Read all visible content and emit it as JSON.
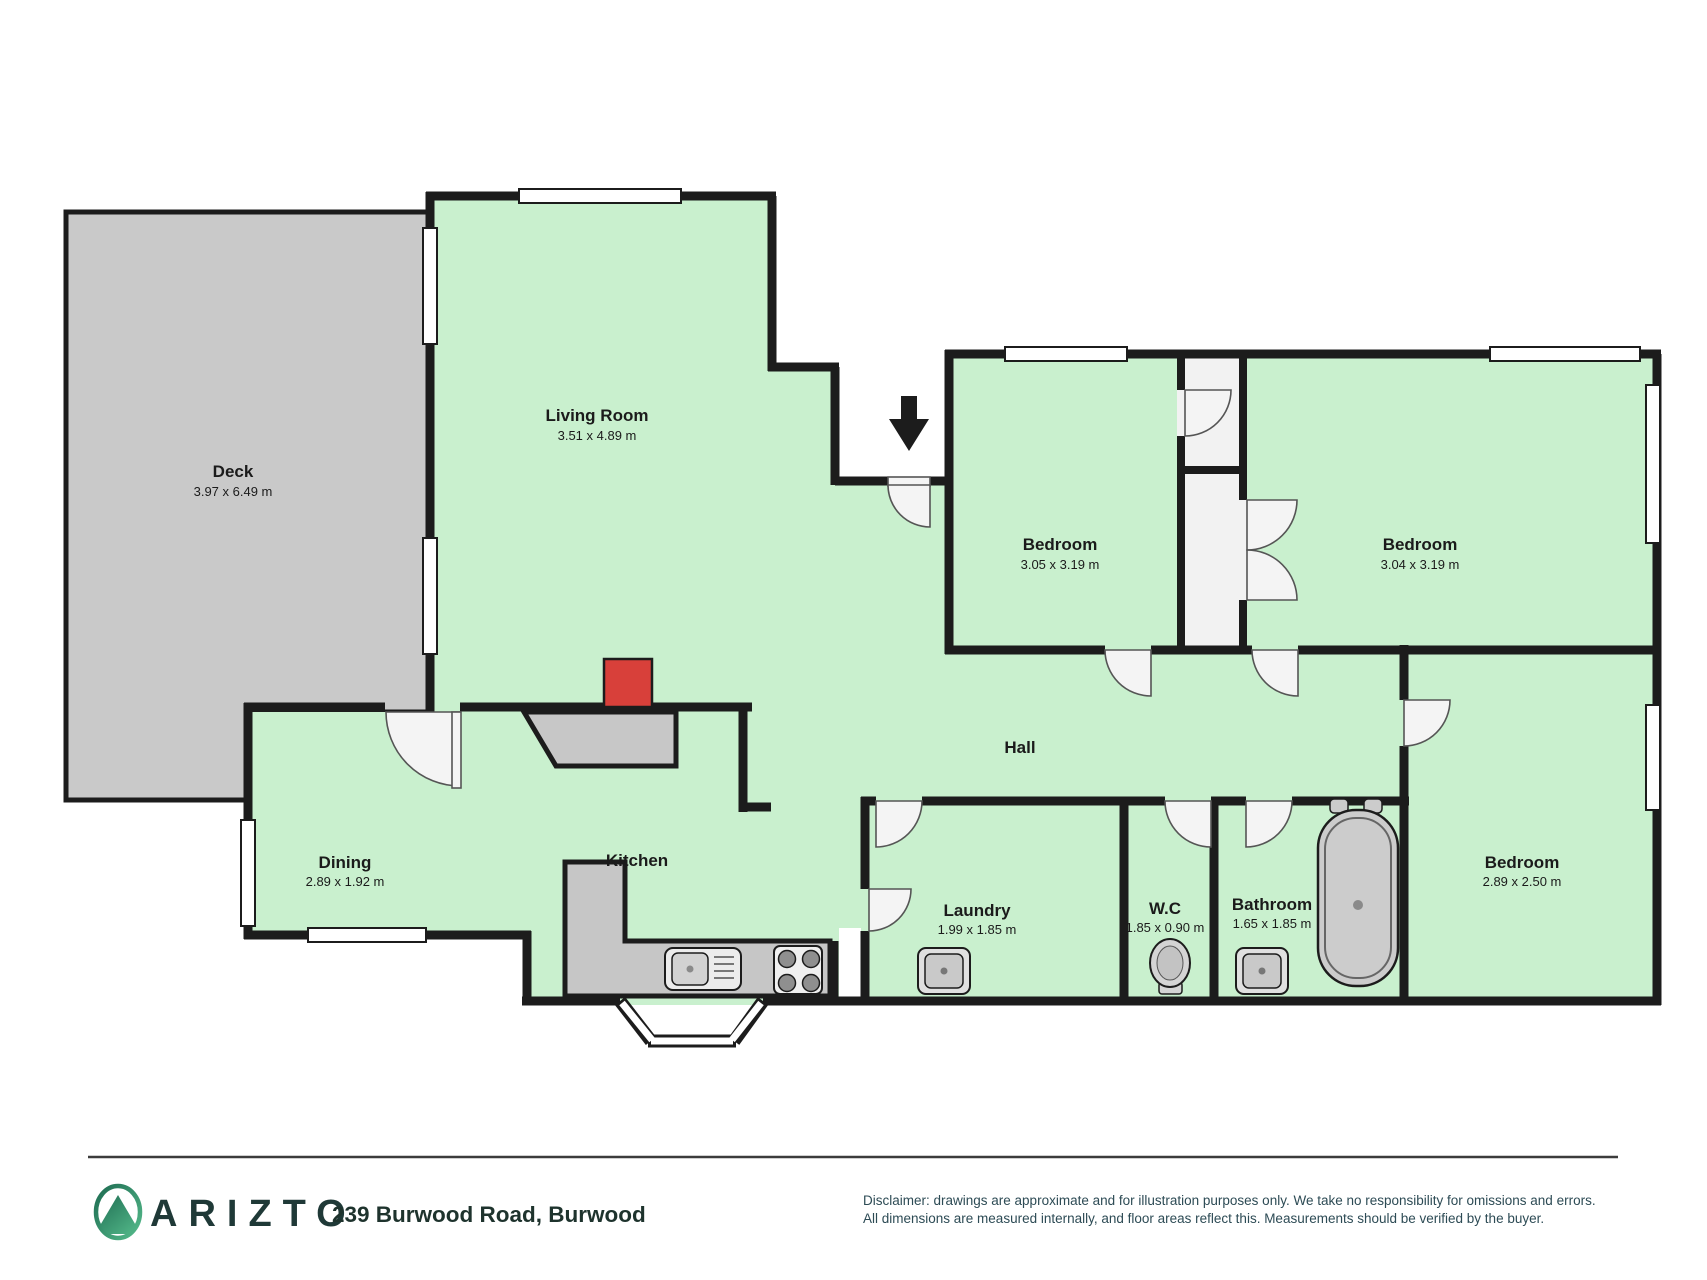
{
  "plan": {
    "rooms": {
      "deck": {
        "name": "Deck",
        "dims": "3.97 x 6.49 m"
      },
      "living": {
        "name": "Living Room",
        "dims": "3.51 x 4.89 m"
      },
      "dining": {
        "name": "Dining",
        "dims": "2.89 x 1.92 m"
      },
      "kitchen": {
        "name": "Kitchen"
      },
      "hall": {
        "name": "Hall"
      },
      "bedroom1": {
        "name": "Bedroom",
        "dims": "3.05 x 3.19 m"
      },
      "bedroom2": {
        "name": "Bedroom",
        "dims": "3.04 x 3.19 m"
      },
      "bedroom3": {
        "name": "Bedroom",
        "dims": "2.89 x 2.50 m"
      },
      "laundry": {
        "name": "Laundry",
        "dims": "1.99 x 1.85 m"
      },
      "wc": {
        "name": "W.C",
        "dims": "1.85 x 0.90 m"
      },
      "bathroom": {
        "name": "Bathroom",
        "dims": "1.65 x 1.85 m"
      }
    },
    "colors": {
      "floor": "#c9f0ce",
      "deck": "#c9c9c9",
      "wall": "#1c1c1c",
      "fireplace": "#d8403a",
      "counter": "#c6c6c6"
    }
  },
  "footer": {
    "brand": "ARIZTO",
    "address": "239 Burwood Road, Burwood",
    "disclaimer_line1": "Disclaimer: drawings are approximate and for illustration purposes only. We take no responsibility for omissions and errors.",
    "disclaimer_line2": "All dimensions are measured internally, and floor areas reflect this. Measurements should be verified by the buyer."
  }
}
